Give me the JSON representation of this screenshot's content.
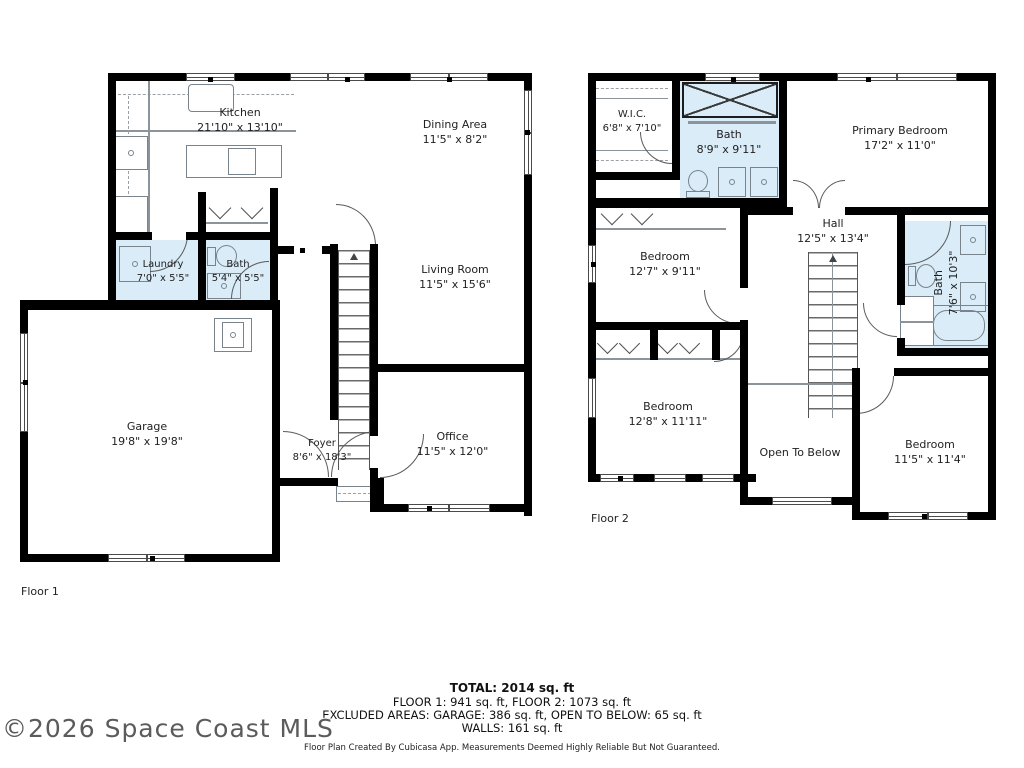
{
  "colors": {
    "wall": "#000000",
    "wet_room_fill": "#d9ecf8",
    "fixture_line": "#79838b",
    "label_text": "#1f1f1f"
  },
  "floor1": {
    "label": "Floor 1",
    "rooms": {
      "kitchen": {
        "name": "Kitchen",
        "dims": "21'10\" x 13'10\""
      },
      "dining": {
        "name": "Dining Area",
        "dims": "11'5\" x 8'2\""
      },
      "living": {
        "name": "Living Room",
        "dims": "11'5\" x 15'6\""
      },
      "laundry": {
        "name": "Laundry",
        "dims": "7'0\" x 5'5\""
      },
      "bath": {
        "name": "Bath",
        "dims": "5'4\" x 5'5\""
      },
      "garage": {
        "name": "Garage",
        "dims": "19'8\" x 19'8\""
      },
      "foyer": {
        "name": "Foyer",
        "dims": "8'6\" x 18'3\""
      },
      "office": {
        "name": "Office",
        "dims": "11'5\" x 12'0\""
      }
    }
  },
  "floor2": {
    "label": "Floor 2",
    "rooms": {
      "wic": {
        "name": "W.I.C.",
        "dims": "6'8\" x 7'10\""
      },
      "bath_upper": {
        "name": "Bath",
        "dims": "8'9\" x 9'11\""
      },
      "primary": {
        "name": "Primary Bedroom",
        "dims": "17'2\" x 11'0\""
      },
      "bedroom_mid": {
        "name": "Bedroom",
        "dims": "12'7\" x 9'11\""
      },
      "hall": {
        "name": "Hall",
        "dims": "12'5\" x 13'4\""
      },
      "bath_right": {
        "name": "Bath",
        "dims": "7'6\" x 10'3\""
      },
      "bedroom_lower_left": {
        "name": "Bedroom",
        "dims": "12'8\" x 11'11\""
      },
      "open_below": {
        "name": "Open To Below"
      },
      "bedroom_lower_right": {
        "name": "Bedroom",
        "dims": "11'5\" x 11'4\""
      }
    }
  },
  "summary": {
    "total": "TOTAL: 2014 sq. ft",
    "floors": "FLOOR 1: 941 sq. ft, FLOOR 2: 1073 sq. ft",
    "excluded": "EXCLUDED AREAS: GARAGE: 386 sq. ft, OPEN TO BELOW: 65 sq. ft",
    "walls": "WALLS: 161 sq. ft",
    "disclaimer": "Floor Plan Created By Cubicasa App. Measurements Deemed Highly Reliable But Not Guaranteed."
  },
  "watermark": "©2026 Space Coast MLS"
}
